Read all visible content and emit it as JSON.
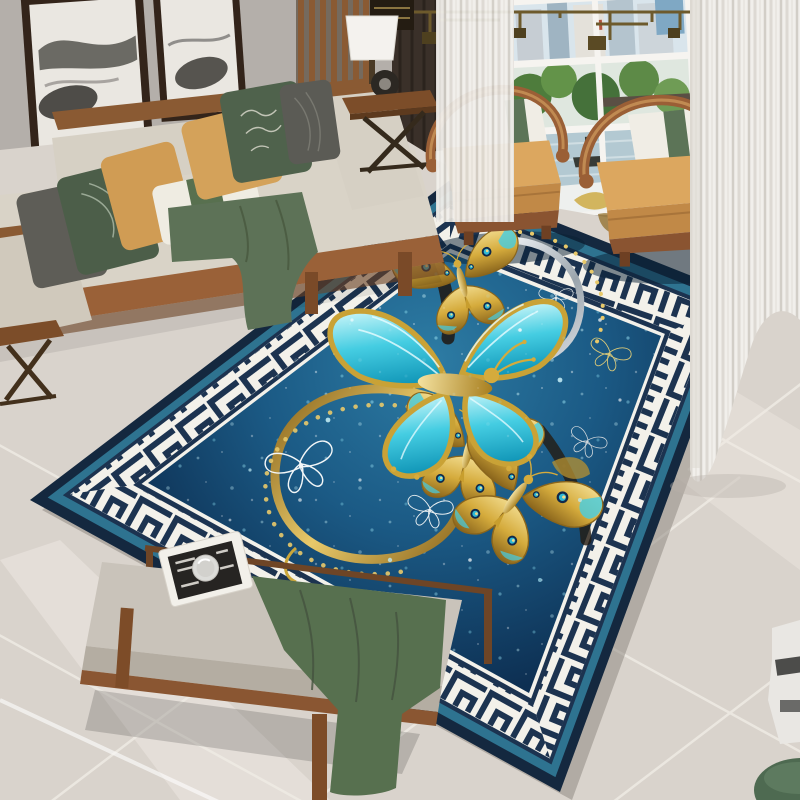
{
  "image": {
    "type": "interior-product-photograph",
    "subject": "Modern Chinese-style living room showcasing a rectangular area rug",
    "rug_description": "Deep teal-blue field with gold and turquoise jewel butterflies, golden swirl with bead chains, sparkle speckles, wide white and navy Greek-key meander border, teal and navy outer banding"
  },
  "palette": {
    "wall": "#b4afaa",
    "floor": "#d9d3cc",
    "grout": "#efebe4",
    "curtain": "#f1efeb",
    "window_trees": "#567f41",
    "window_water": "#b3c9d2",
    "window_sky": "#d9e5ec",
    "wood": "#8a5a33",
    "wood_dark": "#5f3c20",
    "sofa_beige": "#d9d3c7",
    "pillow_mustard": "#d09c54",
    "pillow_green": "#4c5e49",
    "pillow_gray": "#5e5d57",
    "throw_green": "#5d7257",
    "chair_tan": "#dca75f",
    "bench_cushion": "#c9c3ba",
    "runner_green": "#57704f",
    "rug_navy": "#14283f",
    "rug_teal_stripe": "#2e7390",
    "rug_band_white": "#f3f1ea",
    "rug_band_navy": "#1c3350",
    "rug_field_center": "#2d7ca4",
    "rug_field_mid": "#1b5a85",
    "rug_field_edge": "#0d2f52",
    "gold": "#d5ab3c",
    "gold_dark": "#8a651c",
    "gold_light": "#f0d98a",
    "butterfly_teal": "#45cde2",
    "butterfly_teal_light": "#c4f4f8",
    "silver": "#dfe4e8",
    "brass": "#6d5a2c"
  },
  "objects": {
    "paintings": {
      "count": 2,
      "style": "ink-wash mountain art, dark wood frames"
    },
    "ceiling_lamp": {
      "style": "brass geometric linear chandelier"
    },
    "sofa": {
      "style": "wood-frame beige sofa",
      "pillows": [
        "charcoal",
        "forest green patterned",
        "mustard",
        "white with green band",
        "mustard",
        "green with script",
        "charcoal leaf"
      ],
      "throw": "sage green"
    },
    "side_table": {
      "items": [
        "white drum lamp",
        "black disc ornament",
        "books"
      ]
    },
    "armchairs": {
      "count": 2,
      "style": "curved horseshoe wood frame, tan cushion, white pillow with green band"
    },
    "window": {
      "view": [
        "city buildings",
        "trees",
        "river with boat"
      ]
    },
    "curtains": {
      "style": "white sheer"
    },
    "bench": {
      "style": "wood bench with gray cushion",
      "items": [
        "magazine",
        "ribbed glass cup",
        "green runner cloth"
      ]
    },
    "corner_items": [
      "white ceramic stool",
      "green pouf"
    ],
    "rug": {
      "border_pattern": "greek-key meander",
      "motifs": [
        "large teal-gold butterfly",
        "gold butterflies with peacock eye-spots",
        "white outline butterflies",
        "golden S-swirl with bead chains",
        "sparkles"
      ]
    }
  }
}
